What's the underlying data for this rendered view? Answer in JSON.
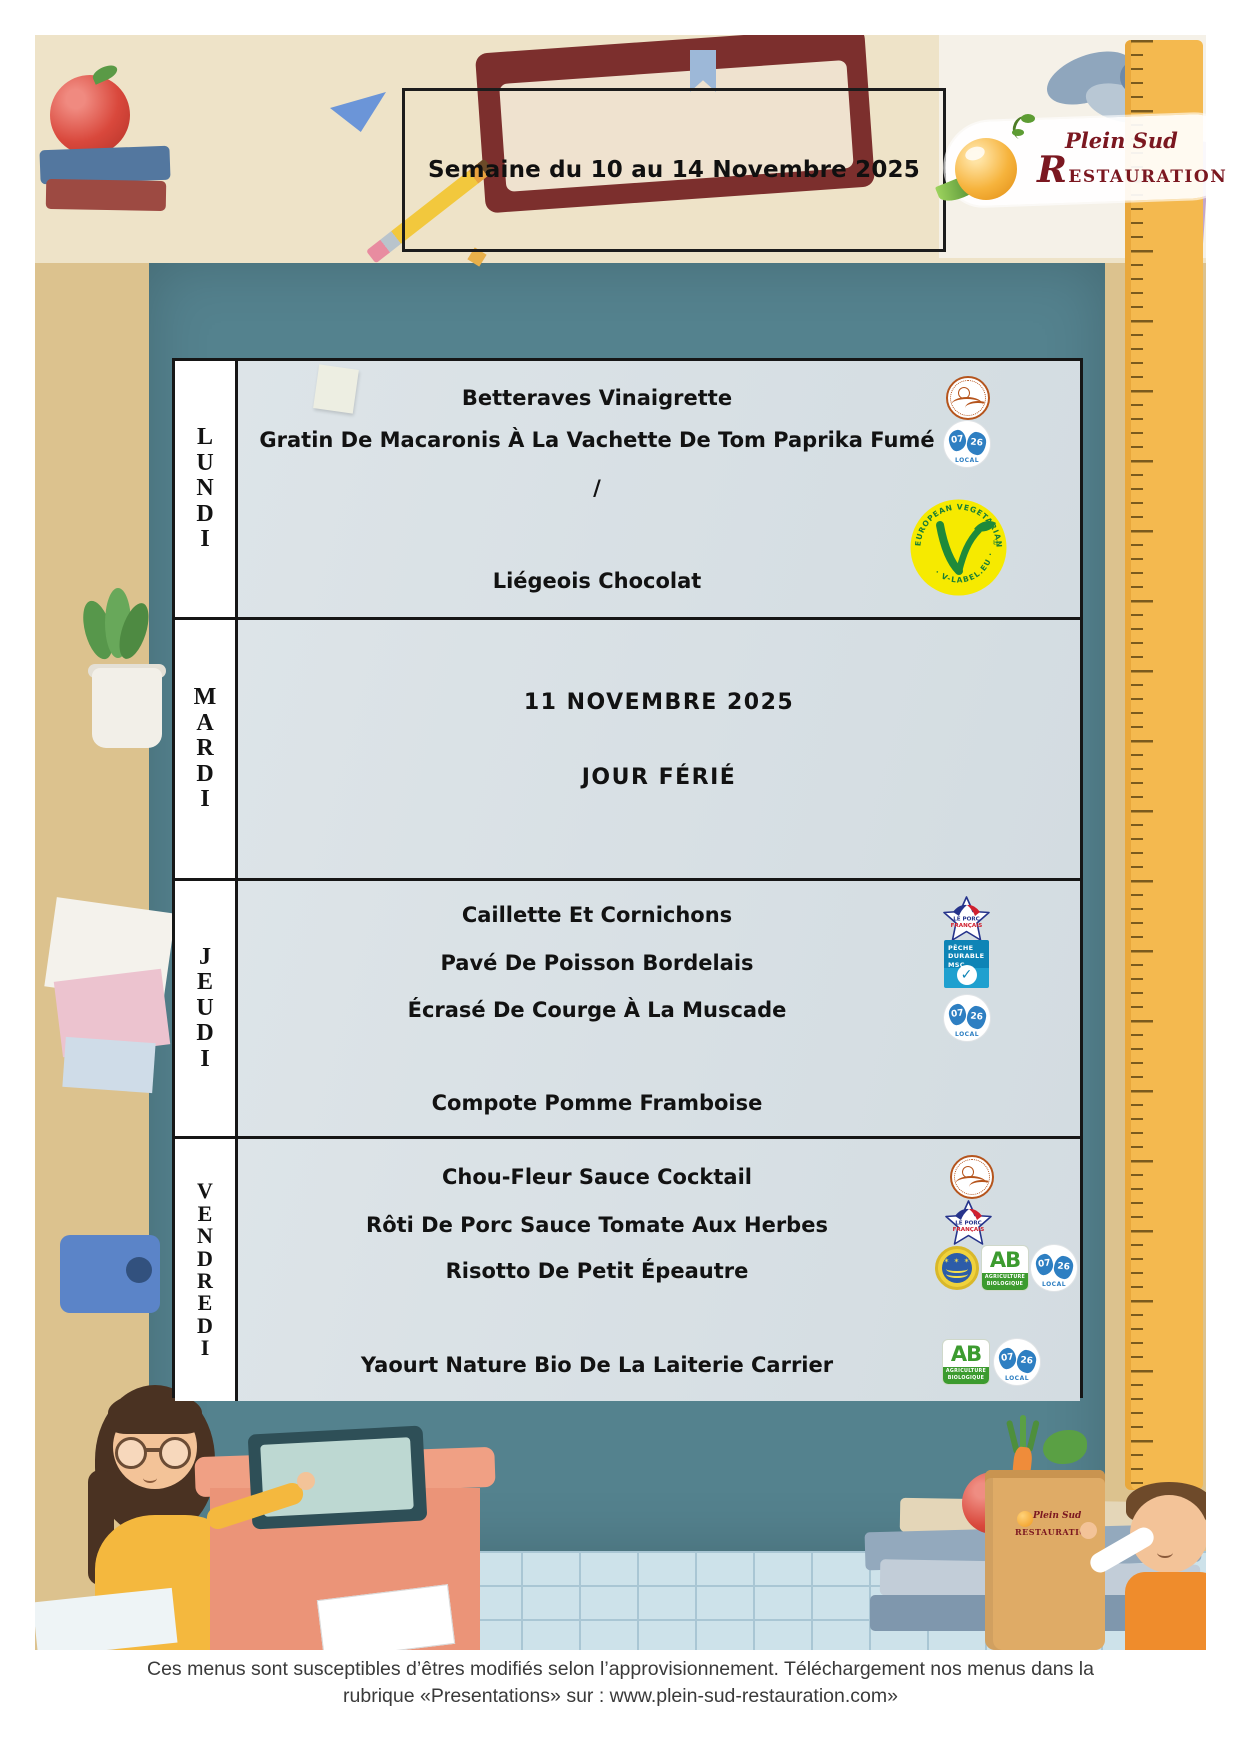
{
  "header": {
    "week_title": "Semaine du 10 au 14 Novembre 2025"
  },
  "logo": {
    "name_line1": "Plein Sud",
    "name_line2": "Restauration"
  },
  "menu": {
    "days": [
      {
        "name": "LUNDI",
        "items": [
          "Betteraves Vinaigrette",
          "Gratin De Macaronis À La Vachette De Tom Paprika Fumé",
          "/",
          "Liégeois Chocolat"
        ],
        "icon_labels": [
          "artisan-seal",
          "local-07-26",
          "v-label-vegetarian"
        ]
      },
      {
        "name": "MARDI",
        "items": [
          "11 NOVEMBRE 2025",
          "JOUR FÉRIÉ"
        ],
        "icon_labels": []
      },
      {
        "name": "JEUDI",
        "items": [
          "Caillette Et Cornichons",
          "Pavé De Poisson Bordelais",
          "Écrasé De Courge À La Muscade",
          "Compote Pomme Framboise"
        ],
        "icon_labels": [
          "porc-francais",
          "msc-peche-durable",
          "local-07-26"
        ]
      },
      {
        "name": "VENDREDI",
        "items": [
          "Chou-Fleur Sauce Cocktail",
          "Rôti De Porc Sauce Tomate Aux Herbes",
          "Risotto De Petit Épeautre",
          "Yaourt Nature Bio De La Laiterie Carrier"
        ],
        "icon_labels": [
          "artisan-seal",
          "porc-francais",
          "organic-eu-seal",
          "ab-bio",
          "local-07-26",
          "ab-bio",
          "local-07-26"
        ]
      }
    ]
  },
  "labels": {
    "local": {
      "dept_top": "07",
      "dept_bottom": "26",
      "caption": "LOCAL"
    },
    "v_label": {
      "arc_top": "EUROPEAN VEGETARIAN UNION",
      "arc_bottom": "· V-LABEL.EU ·",
      "reg": "®"
    },
    "porc_francais": {
      "line1": "LE PORC",
      "line2": "FRANÇAIS"
    },
    "msc": {
      "line1": "PÊCHE",
      "line2": "DURABLE",
      "line3": "MSC",
      "check": "✓"
    },
    "ab": {
      "acronym": "AB",
      "line1": "AGRICULTURE",
      "line2": "BIOLOGIQUE"
    }
  },
  "footer": {
    "line1": "Ces menus sont susceptibles d’êtres modifiés selon l’approvisionnement. Téléchargement nos menus dans la",
    "line2": "rubrique «Presentations» sur : www.plein-sud-restauration.com»"
  },
  "colors": {
    "board_teal": "#54828e",
    "table_bg": "#d8e0e4",
    "frame_tan": "#dcc28e",
    "ruler_yellow": "#f4b94f",
    "logo_red": "#7b1720",
    "v_label_yellow": "#f6ea00",
    "v_label_green": "#1f8a3a",
    "local_blue": "#2e7fc2",
    "msc_blue": "#0e84b6",
    "ab_green": "#3c9b2f",
    "seal_brown": "#b5541c"
  }
}
